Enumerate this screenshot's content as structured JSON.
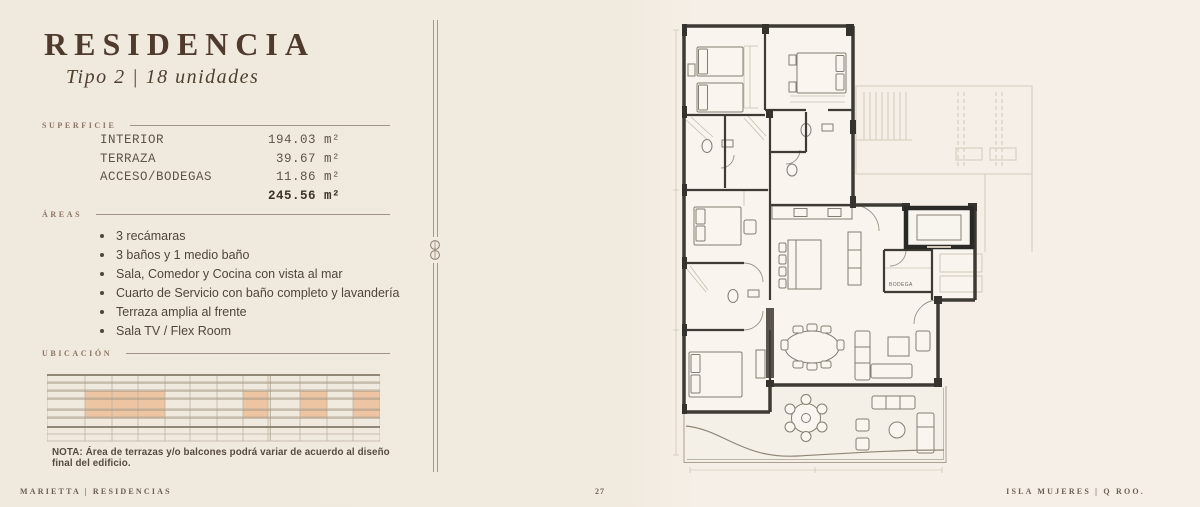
{
  "header": {
    "title": "RESIDENCIA",
    "subtitle": "Tipo 2  |  18 unidades"
  },
  "superficie": {
    "label": "SUPERFICIE",
    "rows": [
      {
        "name": "INTERIOR",
        "value": "194.03 m²"
      },
      {
        "name": "TERRAZA",
        "value": "39.67 m²"
      },
      {
        "name": "ACCESO/BODEGAS",
        "value": "11.86 m²"
      }
    ],
    "total_value": "245.56 m²"
  },
  "areas": {
    "label": "ÁREAS",
    "items": [
      "3 recámaras",
      "3 baños y 1 medio baño",
      "Sala, Comedor y Cocina con vista al mar",
      "Cuarto de Servicio con baño completo y lavandería",
      "Terraza amplia al frente",
      "Sala TV / Flex Room"
    ]
  },
  "ubicacion": {
    "label": "UBICACIÓN",
    "grid": {
      "width": 333,
      "height": 74,
      "cols": [
        0,
        38,
        65,
        91,
        118,
        143,
        170,
        196,
        221,
        253,
        280,
        306,
        333
      ],
      "double_col": 221,
      "rows": [
        3,
        11,
        19,
        27,
        38,
        46,
        55,
        62,
        69
      ],
      "medium_rows": [
        11,
        19,
        27,
        38,
        46
      ],
      "thick_rows": [
        3,
        55
      ],
      "line_color": "#b9ae9e",
      "medium_color": "#a2957f",
      "thick_color": "#847a69",
      "highlight_color": "#eec5a3",
      "highlights": [
        {
          "x": 38,
          "y": 19,
          "w": 80,
          "h": 27
        },
        {
          "x": 196,
          "y": 19,
          "w": 25,
          "h": 27
        },
        {
          "x": 253,
          "y": 19,
          "w": 27,
          "h": 27
        },
        {
          "x": 306,
          "y": 19,
          "w": 27,
          "h": 27
        }
      ]
    }
  },
  "nota": "NOTA: Área de terrazas y/o balcones podrá variar de acuerdo al diseño final del edificio.",
  "footer": {
    "left": "MARIETTA  |  RESIDENCIAS",
    "page_number": "27",
    "right": "ISLA MUJERES  |  Q ROO."
  },
  "plan": {
    "bodega_label": "BODEGA"
  }
}
